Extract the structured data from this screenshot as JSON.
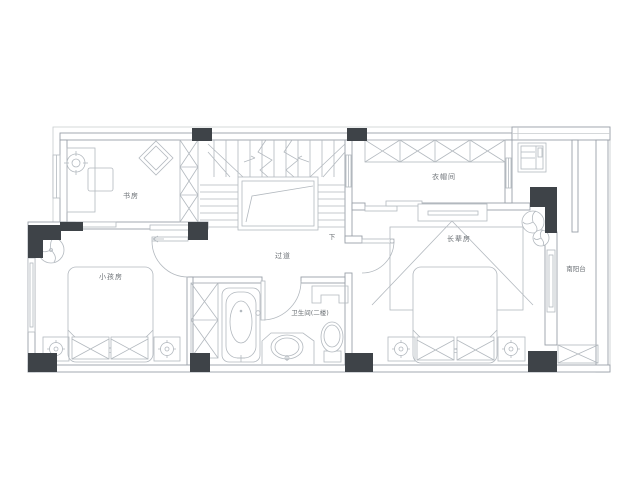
{
  "rooms": {
    "study": {
      "label": "书房"
    },
    "cloakroom": {
      "label": "衣帽间"
    },
    "kids_room": {
      "label": "小孩房"
    },
    "elders_room": {
      "label": "长辈房"
    },
    "hallway": {
      "label": "过道"
    },
    "bathroom": {
      "label": "卫生间(二楼)"
    },
    "south_balcony": {
      "label": "南阳台"
    }
  },
  "stairs": {
    "down_label": "下"
  },
  "colors": {
    "background": "#ffffff",
    "wall_line": "#9aa0a8",
    "furniture_line": "#b3b9bf",
    "column_fill": "#3e4348",
    "label_text": "#6b7075"
  }
}
